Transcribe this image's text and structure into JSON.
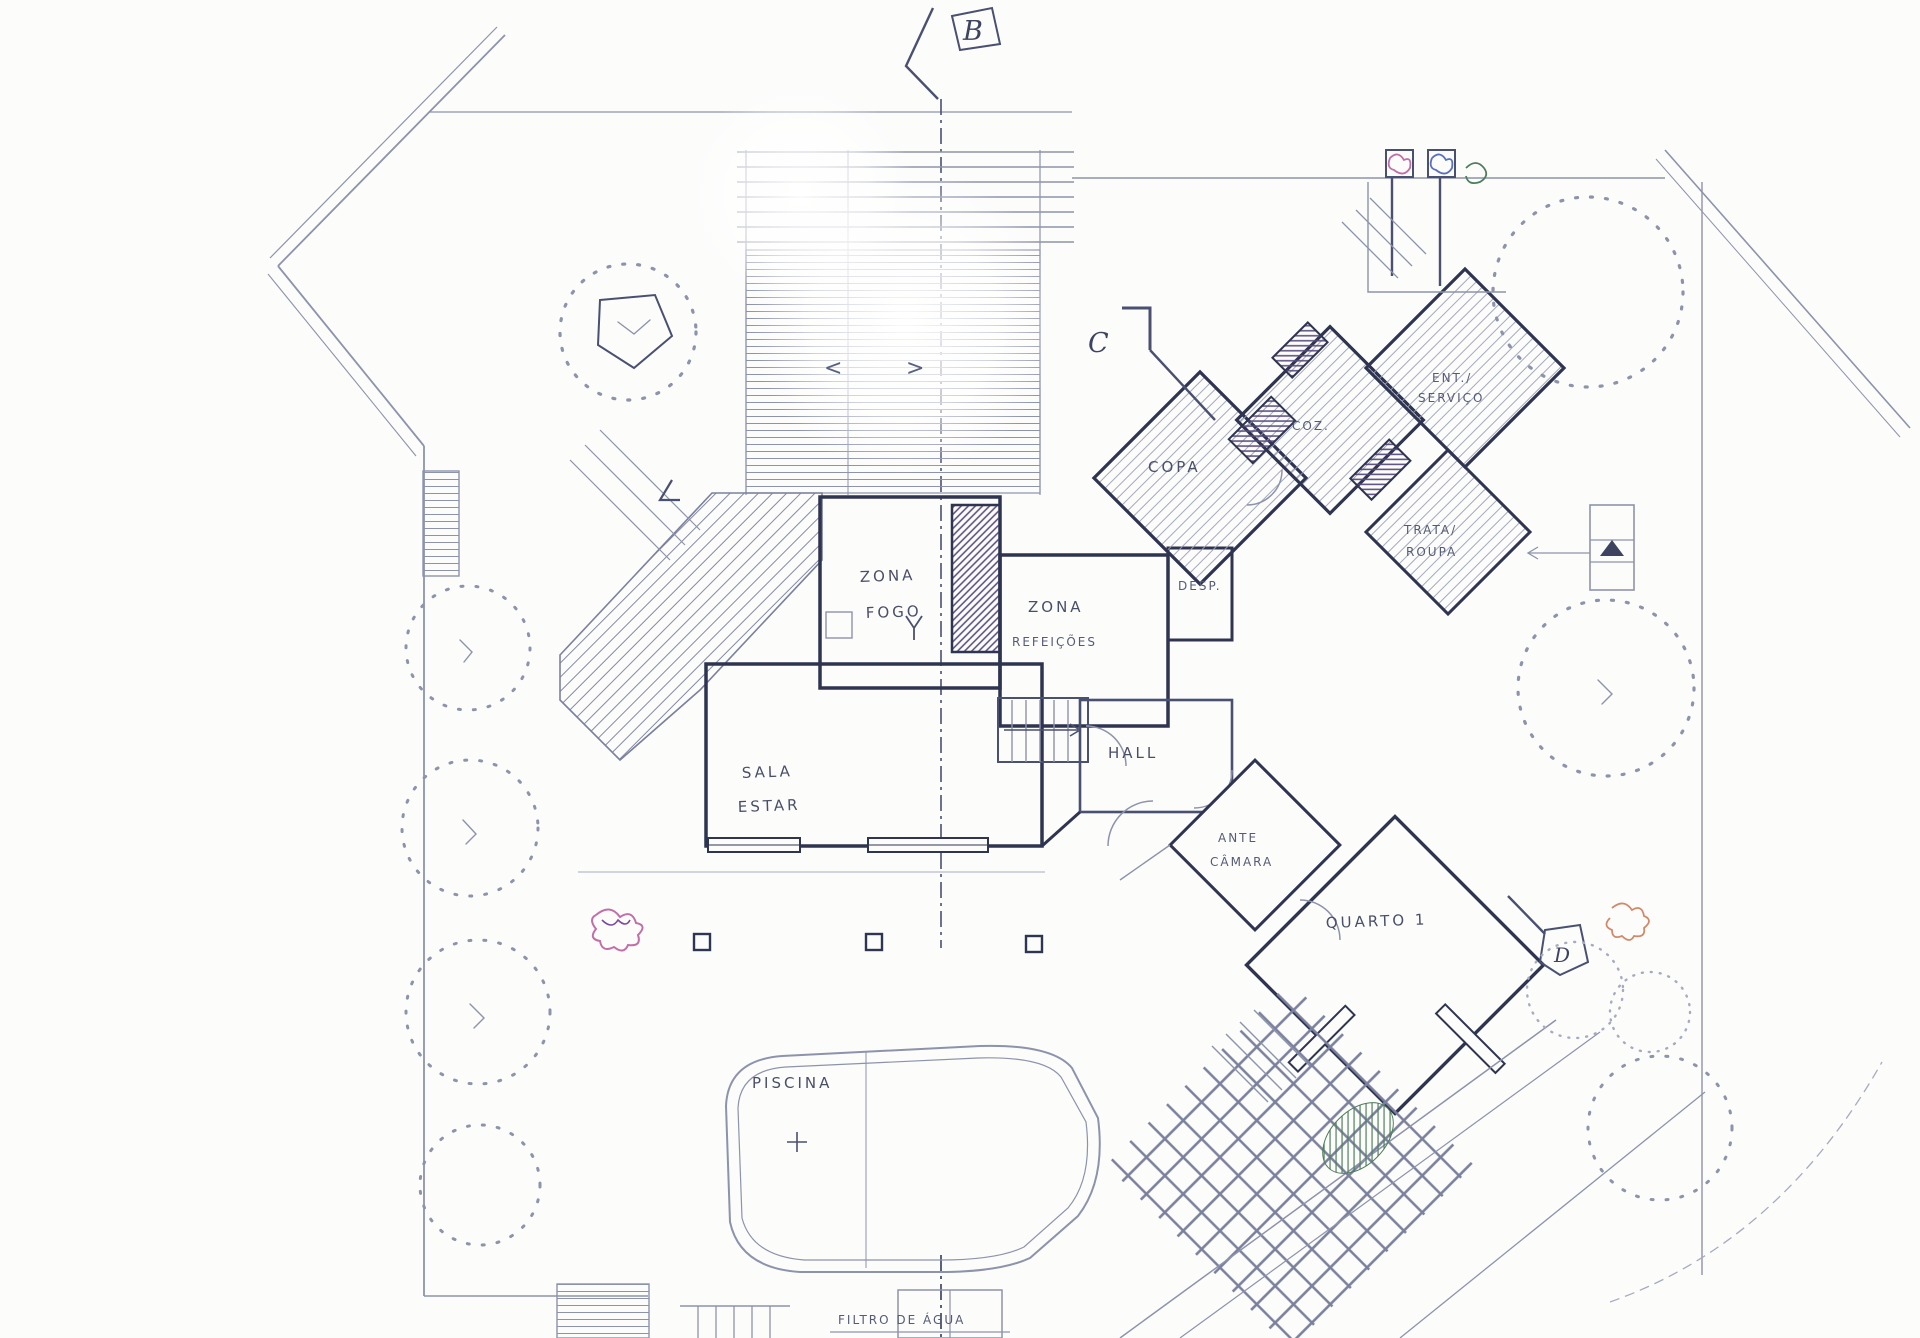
{
  "document": {
    "kind": "hand-drawn architectural site and floor plan",
    "language": "Portuguese"
  },
  "colors": {
    "paper": "#fcfcfb",
    "pencil": "#8d93ab",
    "ink": "#2f3450",
    "accent_purple": "#564a7a",
    "accent_green": "#4f7d5c",
    "accent_pink": "#c06fa8",
    "accent_blue": "#5a6fc0"
  },
  "labels": {
    "section_b": "B",
    "section_c": "C",
    "section_d": "D",
    "zona_fogo": [
      "ZONA",
      "FOGO"
    ],
    "zona_refeicoes": [
      "ZONA",
      "REFEIÇÕES"
    ],
    "sala_estar": [
      "SALA",
      "ESTAR"
    ],
    "hall": "HALL",
    "desp": "DESP.",
    "copa": "COPA",
    "coz": "COZ.",
    "ent_servico": [
      "ENT./",
      "SERVIÇO"
    ],
    "trata_roupa": [
      "TRATA/",
      "ROUPA"
    ],
    "ante_camara": [
      "ANTE",
      "CÂMARA"
    ],
    "quarto": "QUARTO 1",
    "piscina": "PISCINA",
    "filtro_de_agua": "FILTRO DE ÁGUA",
    "deck_arrows": [
      "<",
      ">"
    ]
  }
}
